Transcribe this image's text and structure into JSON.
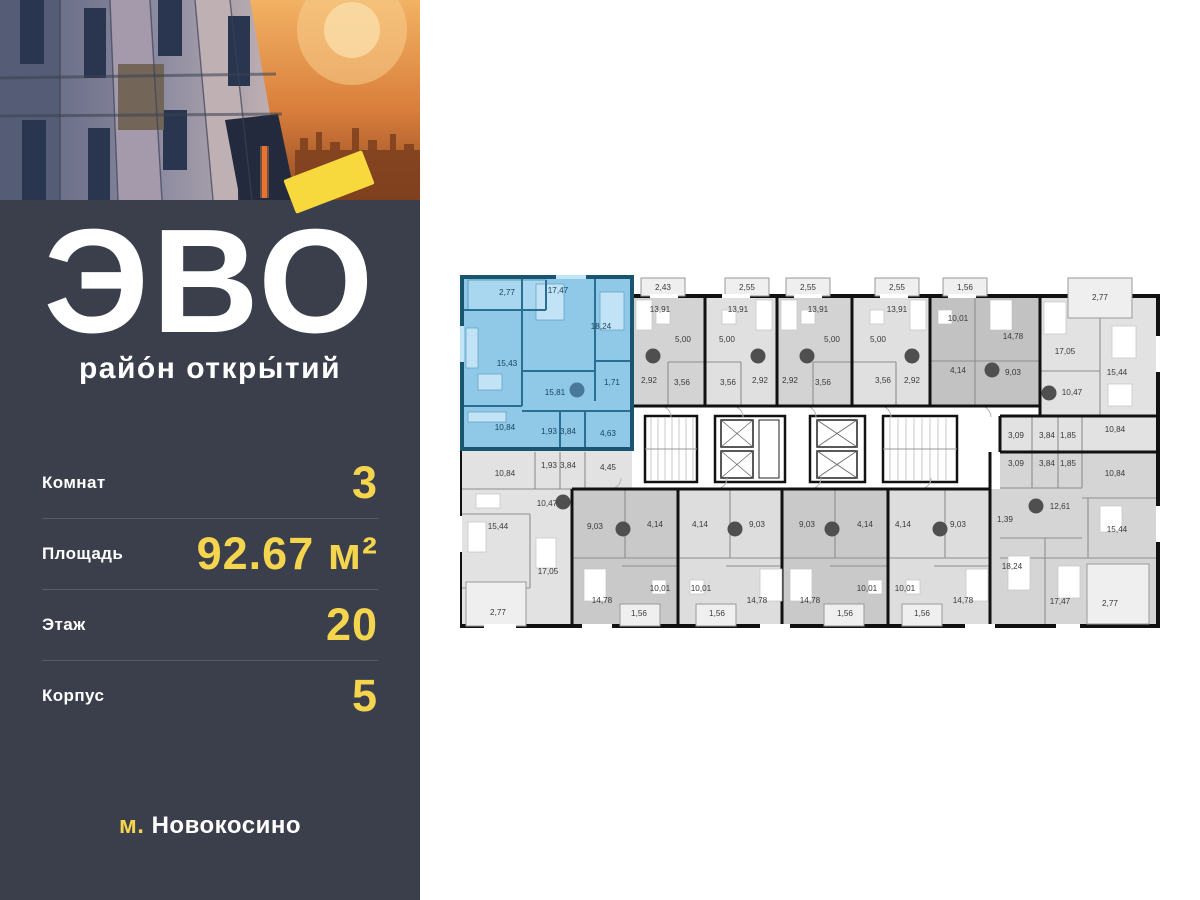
{
  "panel": {
    "logo_text": "ЭВО",
    "logo_subtitle": "райо́н откры́тий",
    "rows": [
      {
        "label": "Комнат",
        "value": "3"
      },
      {
        "label": "Площадь",
        "value": "92.67 м²"
      },
      {
        "label": "Этаж",
        "value": "20"
      },
      {
        "label": "Корпус",
        "value": "5"
      }
    ],
    "metro_prefix": "м.",
    "metro_name": "Новокосино",
    "colors": {
      "background": "#3A3F4B",
      "accent_yellow": "#F5D54D",
      "text": "#FFFFFF"
    }
  },
  "floor_plan": {
    "highlight_color": "#8FC9E7",
    "marker_gray": "#4F4F4F",
    "marker_blue": "#48799A",
    "labels": [
      {
        "x": 47,
        "y": 29,
        "t": "2,77",
        "k": 1
      },
      {
        "x": 98,
        "y": 27,
        "t": "17,47",
        "k": 1
      },
      {
        "x": 141,
        "y": 63,
        "t": "18,24",
        "k": 1
      },
      {
        "x": 47,
        "y": 100,
        "t": "15,43",
        "k": 1
      },
      {
        "x": 95,
        "y": 129,
        "t": "15,81",
        "k": 1
      },
      {
        "x": 152,
        "y": 119,
        "t": "1,71",
        "k": 1
      },
      {
        "x": 45,
        "y": 164,
        "t": "10,84",
        "k": 1
      },
      {
        "x": 89,
        "y": 168,
        "t": "1,93",
        "k": 1
      },
      {
        "x": 108,
        "y": 168,
        "t": "3,84",
        "k": 1
      },
      {
        "x": 148,
        "y": 170,
        "t": "4,63",
        "k": 1
      },
      {
        "x": 203,
        "y": 24,
        "t": "2,43"
      },
      {
        "x": 287,
        "y": 24,
        "t": "2,55"
      },
      {
        "x": 348,
        "y": 24,
        "t": "2,55"
      },
      {
        "x": 437,
        "y": 24,
        "t": "2,55"
      },
      {
        "x": 505,
        "y": 24,
        "t": "1,56"
      },
      {
        "x": 200,
        "y": 46,
        "t": "13,91"
      },
      {
        "x": 278,
        "y": 46,
        "t": "13,91"
      },
      {
        "x": 358,
        "y": 46,
        "t": "13,91"
      },
      {
        "x": 437,
        "y": 46,
        "t": "13,91"
      },
      {
        "x": 223,
        "y": 76,
        "t": "5,00"
      },
      {
        "x": 267,
        "y": 76,
        "t": "5,00"
      },
      {
        "x": 372,
        "y": 76,
        "t": "5,00"
      },
      {
        "x": 418,
        "y": 76,
        "t": "5,00"
      },
      {
        "x": 189,
        "y": 117,
        "t": "2,92"
      },
      {
        "x": 222,
        "y": 119,
        "t": "3,56"
      },
      {
        "x": 268,
        "y": 119,
        "t": "3,56"
      },
      {
        "x": 300,
        "y": 117,
        "t": "2,92"
      },
      {
        "x": 330,
        "y": 117,
        "t": "2,92"
      },
      {
        "x": 363,
        "y": 119,
        "t": "3,56"
      },
      {
        "x": 423,
        "y": 117,
        "t": "3,56"
      },
      {
        "x": 452,
        "y": 117,
        "t": "2,92"
      },
      {
        "x": 498,
        "y": 55,
        "t": "10,01"
      },
      {
        "x": 553,
        "y": 73,
        "t": "14,78"
      },
      {
        "x": 498,
        "y": 107,
        "t": "4,14"
      },
      {
        "x": 553,
        "y": 109,
        "t": "9,03"
      },
      {
        "x": 640,
        "y": 34,
        "t": "2,77"
      },
      {
        "x": 605,
        "y": 88,
        "t": "17,05"
      },
      {
        "x": 657,
        "y": 109,
        "t": "15,44"
      },
      {
        "x": 612,
        "y": 129,
        "t": "10,47"
      },
      {
        "x": 655,
        "y": 166,
        "t": "10,84"
      },
      {
        "x": 556,
        "y": 172,
        "t": "3,09"
      },
      {
        "x": 587,
        "y": 172,
        "t": "3,84"
      },
      {
        "x": 608,
        "y": 172,
        "t": "1,85"
      },
      {
        "x": 556,
        "y": 200,
        "t": "3,09"
      },
      {
        "x": 587,
        "y": 200,
        "t": "3,84"
      },
      {
        "x": 608,
        "y": 200,
        "t": "1,85"
      },
      {
        "x": 655,
        "y": 210,
        "t": "10,84"
      },
      {
        "x": 545,
        "y": 256,
        "t": "1,39"
      },
      {
        "x": 600,
        "y": 243,
        "t": "12,61"
      },
      {
        "x": 657,
        "y": 266,
        "t": "15,44"
      },
      {
        "x": 552,
        "y": 303,
        "t": "18,24"
      },
      {
        "x": 600,
        "y": 338,
        "t": "17,47"
      },
      {
        "x": 650,
        "y": 340,
        "t": "2,77"
      },
      {
        "x": 45,
        "y": 210,
        "t": "10,84"
      },
      {
        "x": 89,
        "y": 202,
        "t": "1,93"
      },
      {
        "x": 108,
        "y": 202,
        "t": "3,84"
      },
      {
        "x": 148,
        "y": 204,
        "t": "4,45"
      },
      {
        "x": 87,
        "y": 240,
        "t": "10,47"
      },
      {
        "x": 38,
        "y": 263,
        "t": "15,44"
      },
      {
        "x": 88,
        "y": 308,
        "t": "17,05"
      },
      {
        "x": 38,
        "y": 349,
        "t": "2,77"
      },
      {
        "x": 135,
        "y": 263,
        "t": "9,03"
      },
      {
        "x": 142,
        "y": 337,
        "t": "14,78"
      },
      {
        "x": 195,
        "y": 261,
        "t": "4,14"
      },
      {
        "x": 200,
        "y": 325,
        "t": "10,01"
      },
      {
        "x": 179,
        "y": 350,
        "t": "1,56"
      },
      {
        "x": 240,
        "y": 261,
        "t": "4,14"
      },
      {
        "x": 241,
        "y": 325,
        "t": "10,01"
      },
      {
        "x": 257,
        "y": 350,
        "t": "1,56"
      },
      {
        "x": 297,
        "y": 261,
        "t": "9,03"
      },
      {
        "x": 297,
        "y": 337,
        "t": "14,78"
      },
      {
        "x": 347,
        "y": 261,
        "t": "9,03"
      },
      {
        "x": 350,
        "y": 337,
        "t": "14,78"
      },
      {
        "x": 405,
        "y": 261,
        "t": "4,14"
      },
      {
        "x": 407,
        "y": 325,
        "t": "10,01"
      },
      {
        "x": 385,
        "y": 350,
        "t": "1,56"
      },
      {
        "x": 443,
        "y": 261,
        "t": "4,14"
      },
      {
        "x": 445,
        "y": 325,
        "t": "10,01"
      },
      {
        "x": 462,
        "y": 350,
        "t": "1,56"
      },
      {
        "x": 498,
        "y": 261,
        "t": "9,03"
      },
      {
        "x": 503,
        "y": 337,
        "t": "14,78"
      }
    ],
    "circles": [
      {
        "x": 117,
        "y": 124,
        "k": 1
      },
      {
        "x": 193,
        "y": 90
      },
      {
        "x": 298,
        "y": 90
      },
      {
        "x": 347,
        "y": 90
      },
      {
        "x": 452,
        "y": 90
      },
      {
        "x": 532,
        "y": 104
      },
      {
        "x": 589,
        "y": 127
      },
      {
        "x": 576,
        "y": 240
      },
      {
        "x": 103,
        "y": 236
      },
      {
        "x": 163,
        "y": 263
      },
      {
        "x": 275,
        "y": 263
      },
      {
        "x": 372,
        "y": 263
      },
      {
        "x": 480,
        "y": 263
      }
    ]
  }
}
